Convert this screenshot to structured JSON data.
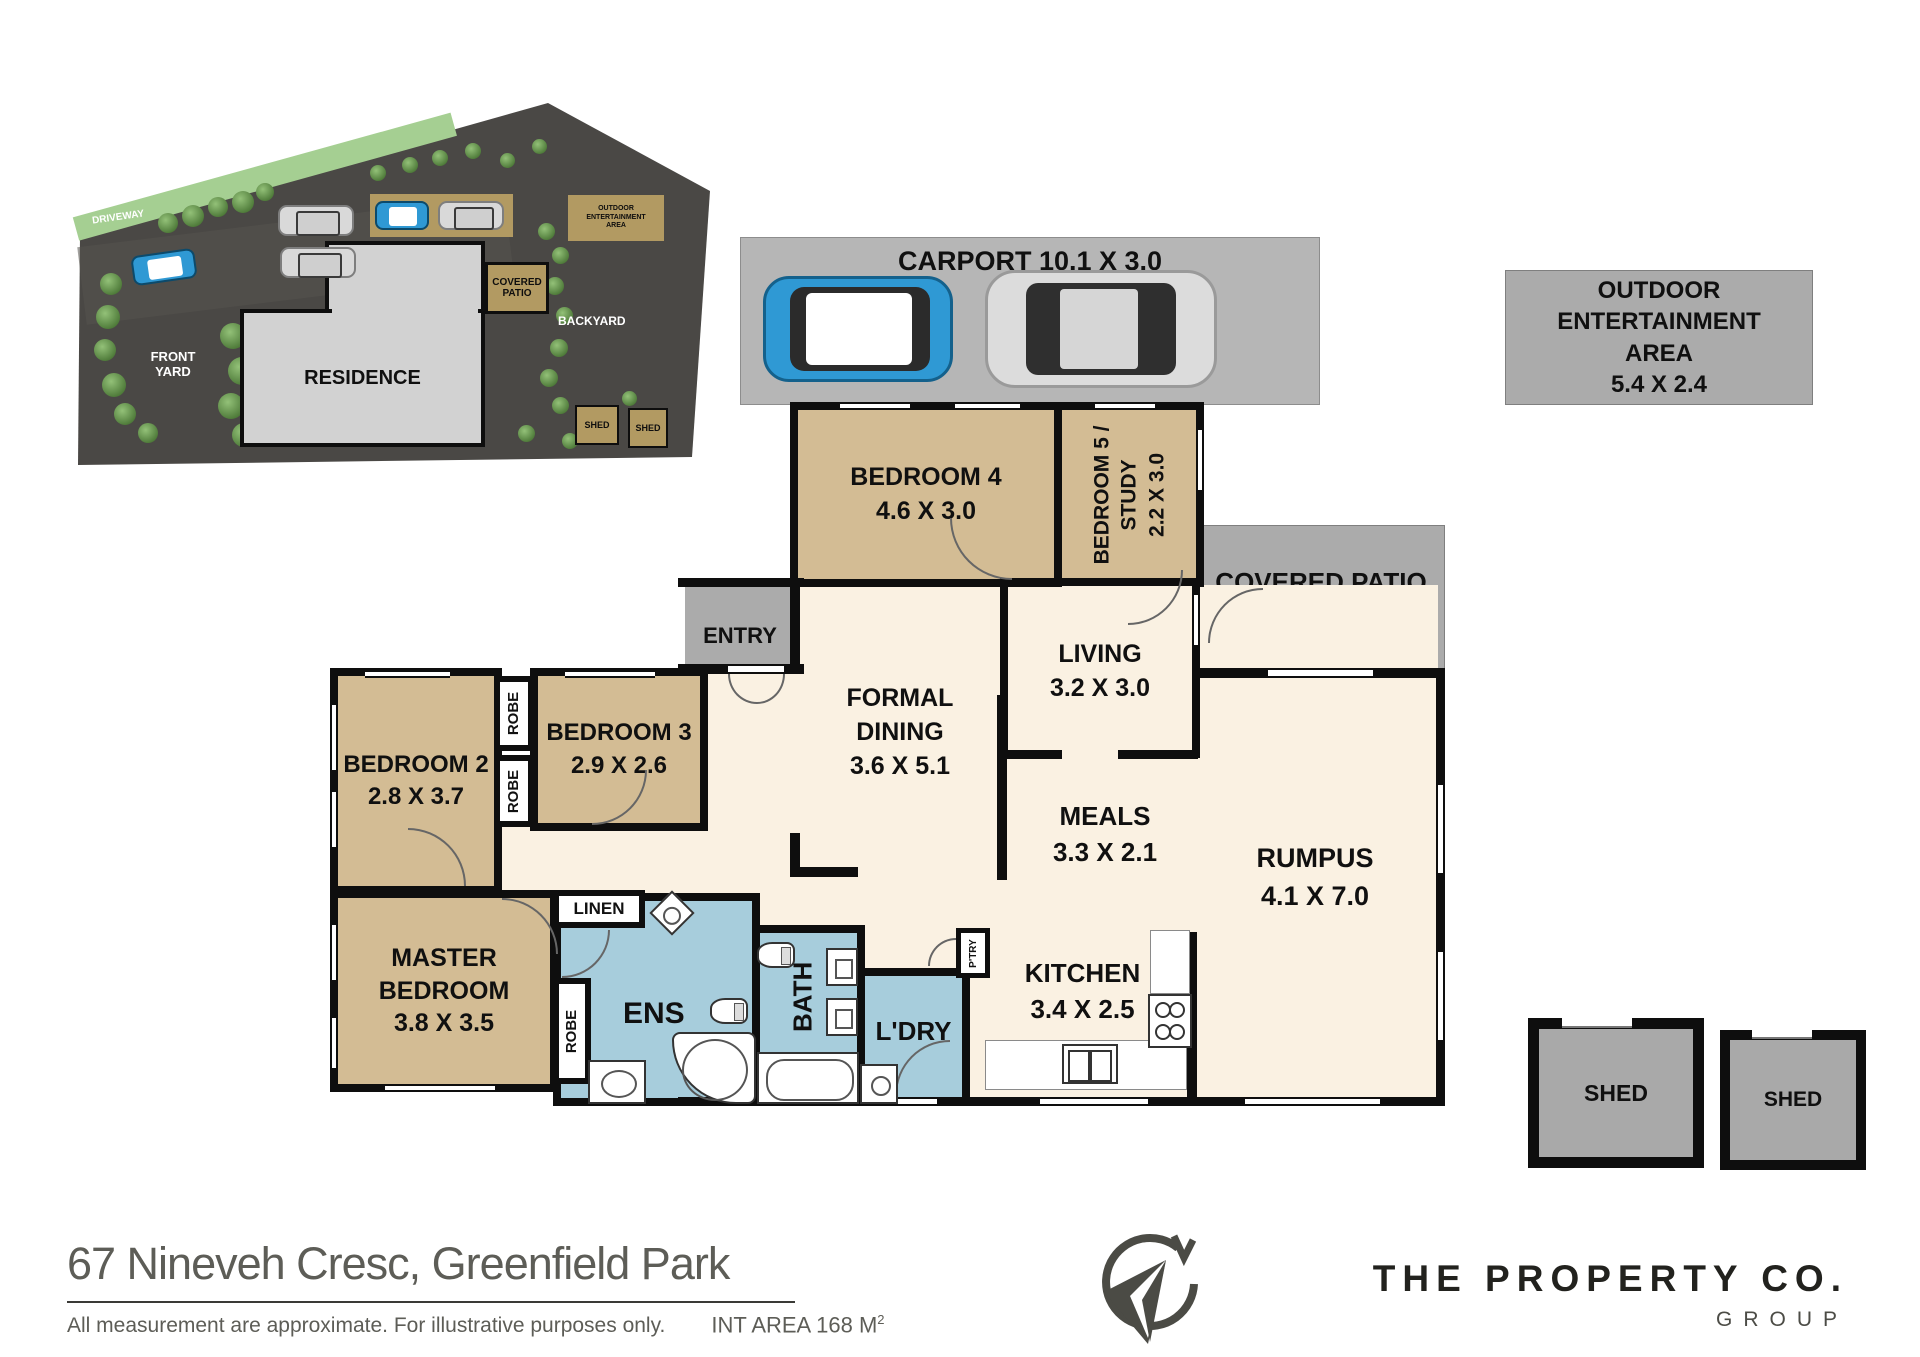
{
  "page": {
    "address": "67 Nineveh Cresc, Greenfield Park",
    "disclaimer": "All measurement are approximate. For illustrative purposes only.",
    "int_area_prefix": "INT AREA 168 M",
    "int_area_sup": "2"
  },
  "branding": {
    "company": "THE PROPERTY CO.",
    "group": "GROUP",
    "compass_letter": "N"
  },
  "colors": {
    "bedroom_tan": "#d3bc94",
    "living_cream": "#faf1e2",
    "wet_blue": "#a7cddc",
    "patio_gray": "#ababab",
    "carport_gray": "#b6b6b6",
    "wall": "#0e0e0e",
    "site_lot": "#4a4845",
    "site_grass": "#a5cf92",
    "site_structure_tan": "#b29a62",
    "car_blue": "#2f99d4",
    "car_silver": "#dcdcdc"
  },
  "site_plan": {
    "driveway": "DRIVEWAY",
    "front_yard": "FRONT YARD",
    "residence": "RESIDENCE",
    "covered_patio": "COVERED PATIO",
    "backyard": "BACKYARD",
    "outdoor_l1": "OUTDOOR",
    "outdoor_l2": "ENTERTAINMENT",
    "outdoor_l3": "AREA",
    "shed1": "SHED",
    "shed2": "SHED"
  },
  "rooms": {
    "carport": {
      "label": "CARPORT 10.1 X 3.0"
    },
    "outdoor": {
      "l1": "OUTDOOR",
      "l2": "ENTERTAINMENT",
      "l3": "AREA",
      "dims": "5.4 X 2.4"
    },
    "bedroom4": {
      "name": "BEDROOM 4",
      "dims": "4.6 X 3.0"
    },
    "bedroom5": {
      "l1": "BEDROOM 5 /",
      "l2": "STUDY",
      "dims": "2.2 X 3.0"
    },
    "covered_patio": {
      "name": "COVERED PATIO",
      "dims": "4.2 X 3.6"
    },
    "living": {
      "name": "LIVING",
      "dims": "3.2 X 3.0"
    },
    "entry": {
      "name": "ENTRY"
    },
    "formal_dining": {
      "l1": "FORMAL",
      "l2": "DINING",
      "dims": "3.6 X 5.1"
    },
    "bedroom3": {
      "name": "BEDROOM 3",
      "dims": "2.9 X 2.6"
    },
    "bedroom2": {
      "name": "BEDROOM 2",
      "dims": "2.8 X 3.7"
    },
    "robe": "ROBE",
    "linen": "LINEN",
    "master": {
      "l1": "MASTER",
      "l2": "BEDROOM",
      "dims": "3.8 X 3.5"
    },
    "ens": "ENS",
    "bath": "BATH",
    "ldry": "L'DRY",
    "ptry": "P'TRY",
    "kitchen": {
      "name": "KITCHEN",
      "dims": "3.4 X 2.5"
    },
    "meals": {
      "name": "MEALS",
      "dims": "3.3 X 2.1"
    },
    "rumpus": {
      "name": "RUMPUS",
      "dims": "4.1 X 7.0"
    },
    "shed": "SHED"
  }
}
